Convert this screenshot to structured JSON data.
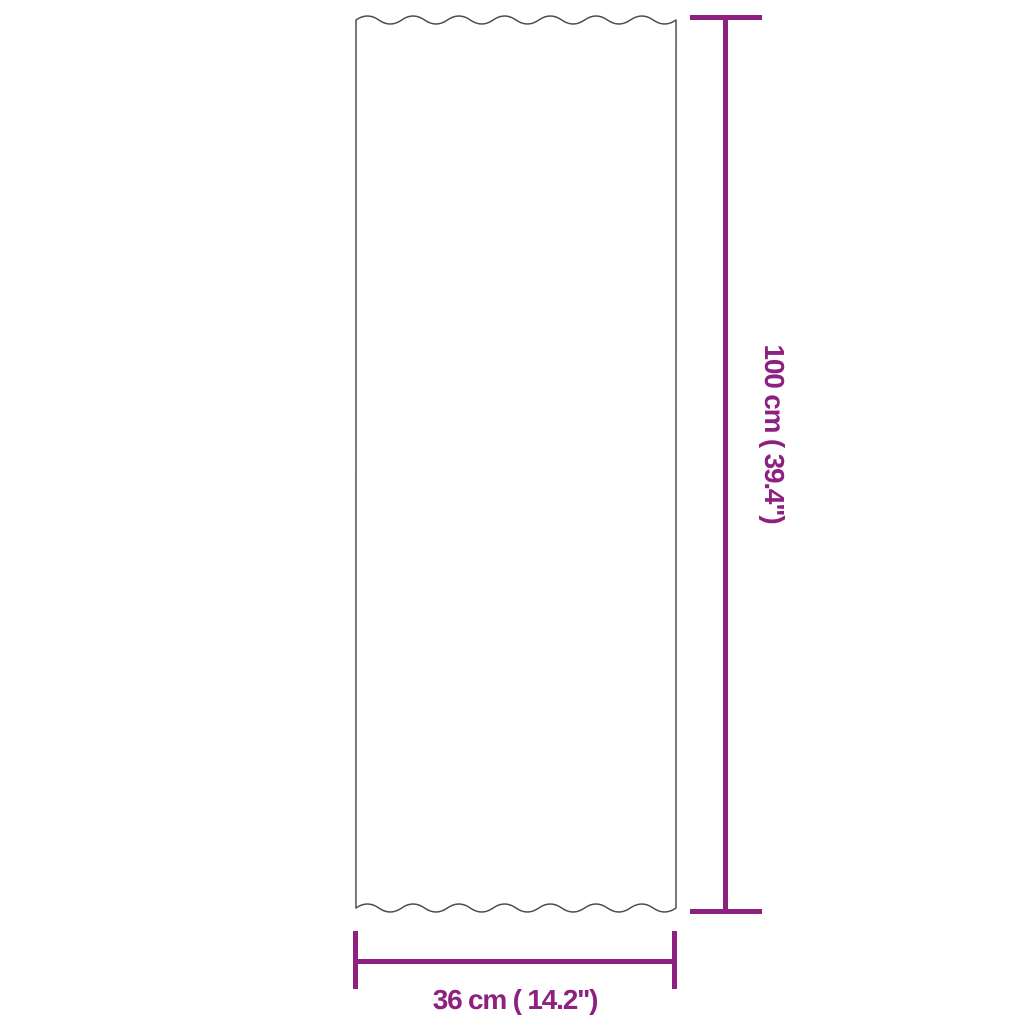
{
  "diagram": {
    "subject": "corrugated-roof-panel-dimension-diagram",
    "height_dimension": {
      "label": "100 cm ( 39.4\")",
      "value_cm": "100",
      "value_inches": "39.4"
    },
    "width_dimension": {
      "label": "36 cm ( 14.2\")",
      "value_cm": "36",
      "value_inches": "14.2"
    },
    "colors": {
      "dimension": "#8e2080",
      "outline": "#4d4d4d",
      "background": "#ffffff"
    }
  }
}
